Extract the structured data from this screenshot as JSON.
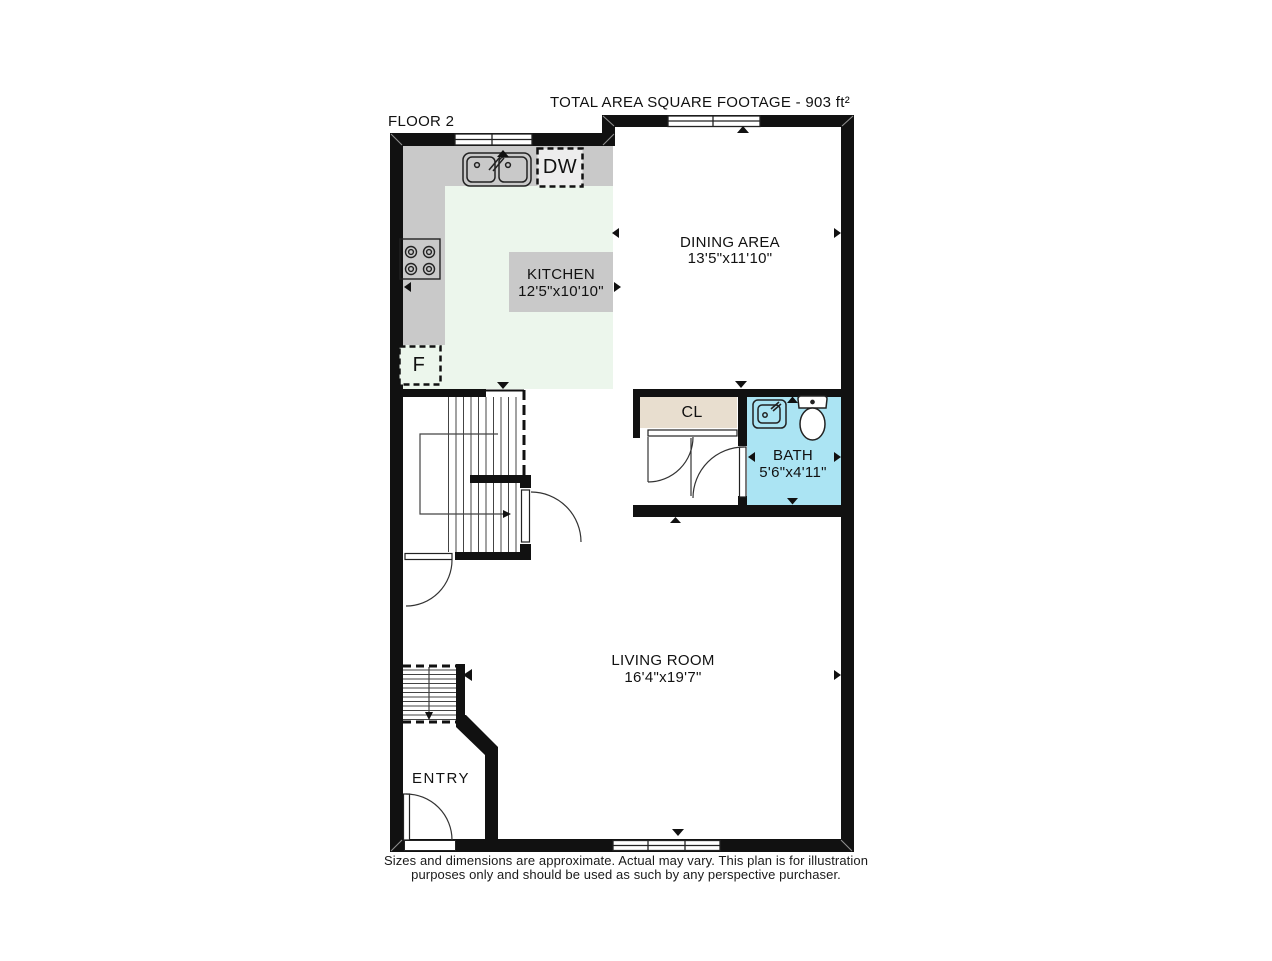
{
  "title": "TOTAL AREA SQUARE FOOTAGE - 903 ft²",
  "floor_label": "FLOOR 2",
  "rooms": {
    "kitchen": {
      "name": "KITCHEN",
      "dims": "12'5\"x10'10\""
    },
    "dining": {
      "name": "DINING AREA",
      "dims": "13'5\"x11'10\""
    },
    "bath": {
      "name": "BATH",
      "dims": "5'6\"x4'11\""
    },
    "living": {
      "name": "LIVING ROOM",
      "dims": "16'4\"x19'7\""
    },
    "entry": {
      "name": "ENTRY"
    },
    "closet": {
      "name": "CL"
    }
  },
  "appliances": {
    "dishwasher": "DW",
    "fridge": "F"
  },
  "disclaimer": {
    "line1": "Sizes and dimensions are approximate. Actual may vary. This plan is for illustration",
    "line2": "purposes only and should be used as such by any perspective purchaser."
  },
  "colors": {
    "wall": "#111111",
    "kitchen_floor": "#ecf6ec",
    "counter": "#c9c9c9",
    "label_box": "#c9c9c9",
    "closet": "#e8decf",
    "bath": "#abe4f3"
  }
}
